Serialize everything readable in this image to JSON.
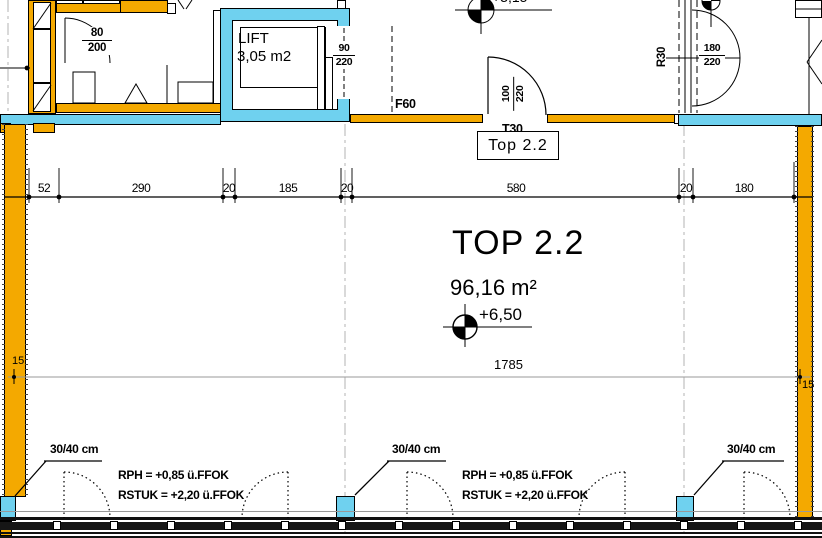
{
  "unit": {
    "title": "TOP 2.2",
    "area": "96,16 m²",
    "level": "+6,50",
    "tag": "Top 2.2"
  },
  "upper_level_partial": "+3,15",
  "lift": {
    "name": "LIFT",
    "area": "3,05 m2",
    "door_w": "90",
    "door_h": "220"
  },
  "doors": {
    "bath_w": "80",
    "bath_h": "200",
    "entry_w": "100",
    "entry_h": "220",
    "right_w": "180",
    "right_h": "220"
  },
  "labels": {
    "fire_wall": "F60",
    "fire_door": "T30",
    "radius": "R30"
  },
  "dimensions": {
    "top_row": [
      "52",
      "290",
      "20",
      "185",
      "20",
      "580",
      "20",
      "180"
    ],
    "total": "1785",
    "wall_left": "15",
    "wall_right": "15"
  },
  "bottom": {
    "column_size": "30/40 cm",
    "rph": "RPH  =  +0,85  ü.FFOK",
    "rstuk": "RSTUK  =  +2,20  ü.FFOK"
  },
  "colors": {
    "wall_load_bearing": "#f4a900",
    "wall_concrete": "#6fd1ef"
  }
}
